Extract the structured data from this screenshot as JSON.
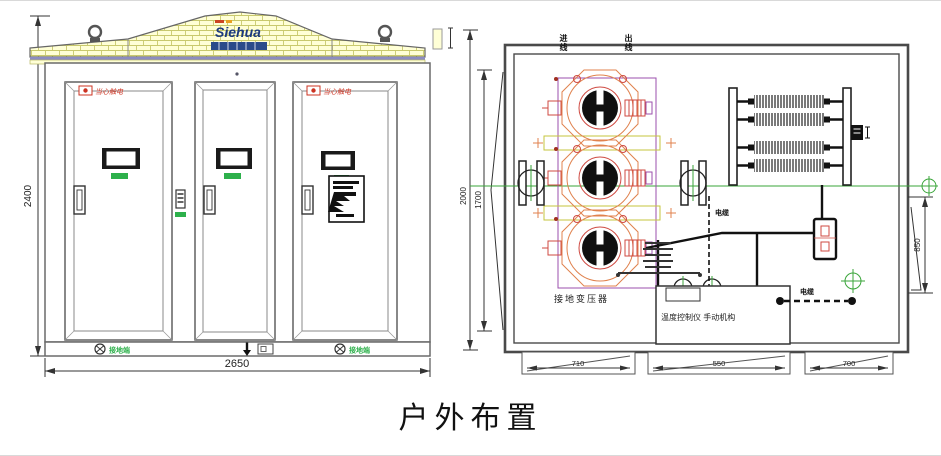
{
  "title": "户外布置",
  "front_view": {
    "logo_text": "Siehua",
    "dim_height": "2400",
    "dim_width": "2650",
    "warning_label_left_door": "当心触电",
    "warning_label_right_door": "当心触电",
    "ground_label_left": "接地端",
    "ground_label_right": "接地端"
  },
  "plan_view": {
    "dim_outer_height": "2000",
    "dim_inner_height": "1700",
    "dim_right_height": "850",
    "dim_bottom_left": "710",
    "dim_bottom_middle": "550",
    "dim_bottom_right": "700",
    "transformer_label": "接地变压器",
    "control_box_label": "温度控制仪 手动机构",
    "top_label_in": "进线",
    "top_label_out": "出线",
    "cable_label": "电缆",
    "tray_label": "电缆"
  },
  "colors": {
    "roof_fill": "#ffffd6",
    "roof_grid": "#c9c96d",
    "accent_green": "#2db04b",
    "warning_red": "#cc3322",
    "logo_blue": "#1c3a7e",
    "transformer_orange": "#e0824e",
    "transformer_red": "#cf4a42",
    "purple": "#9b4fae",
    "centerline_green": "#3aa53a"
  }
}
